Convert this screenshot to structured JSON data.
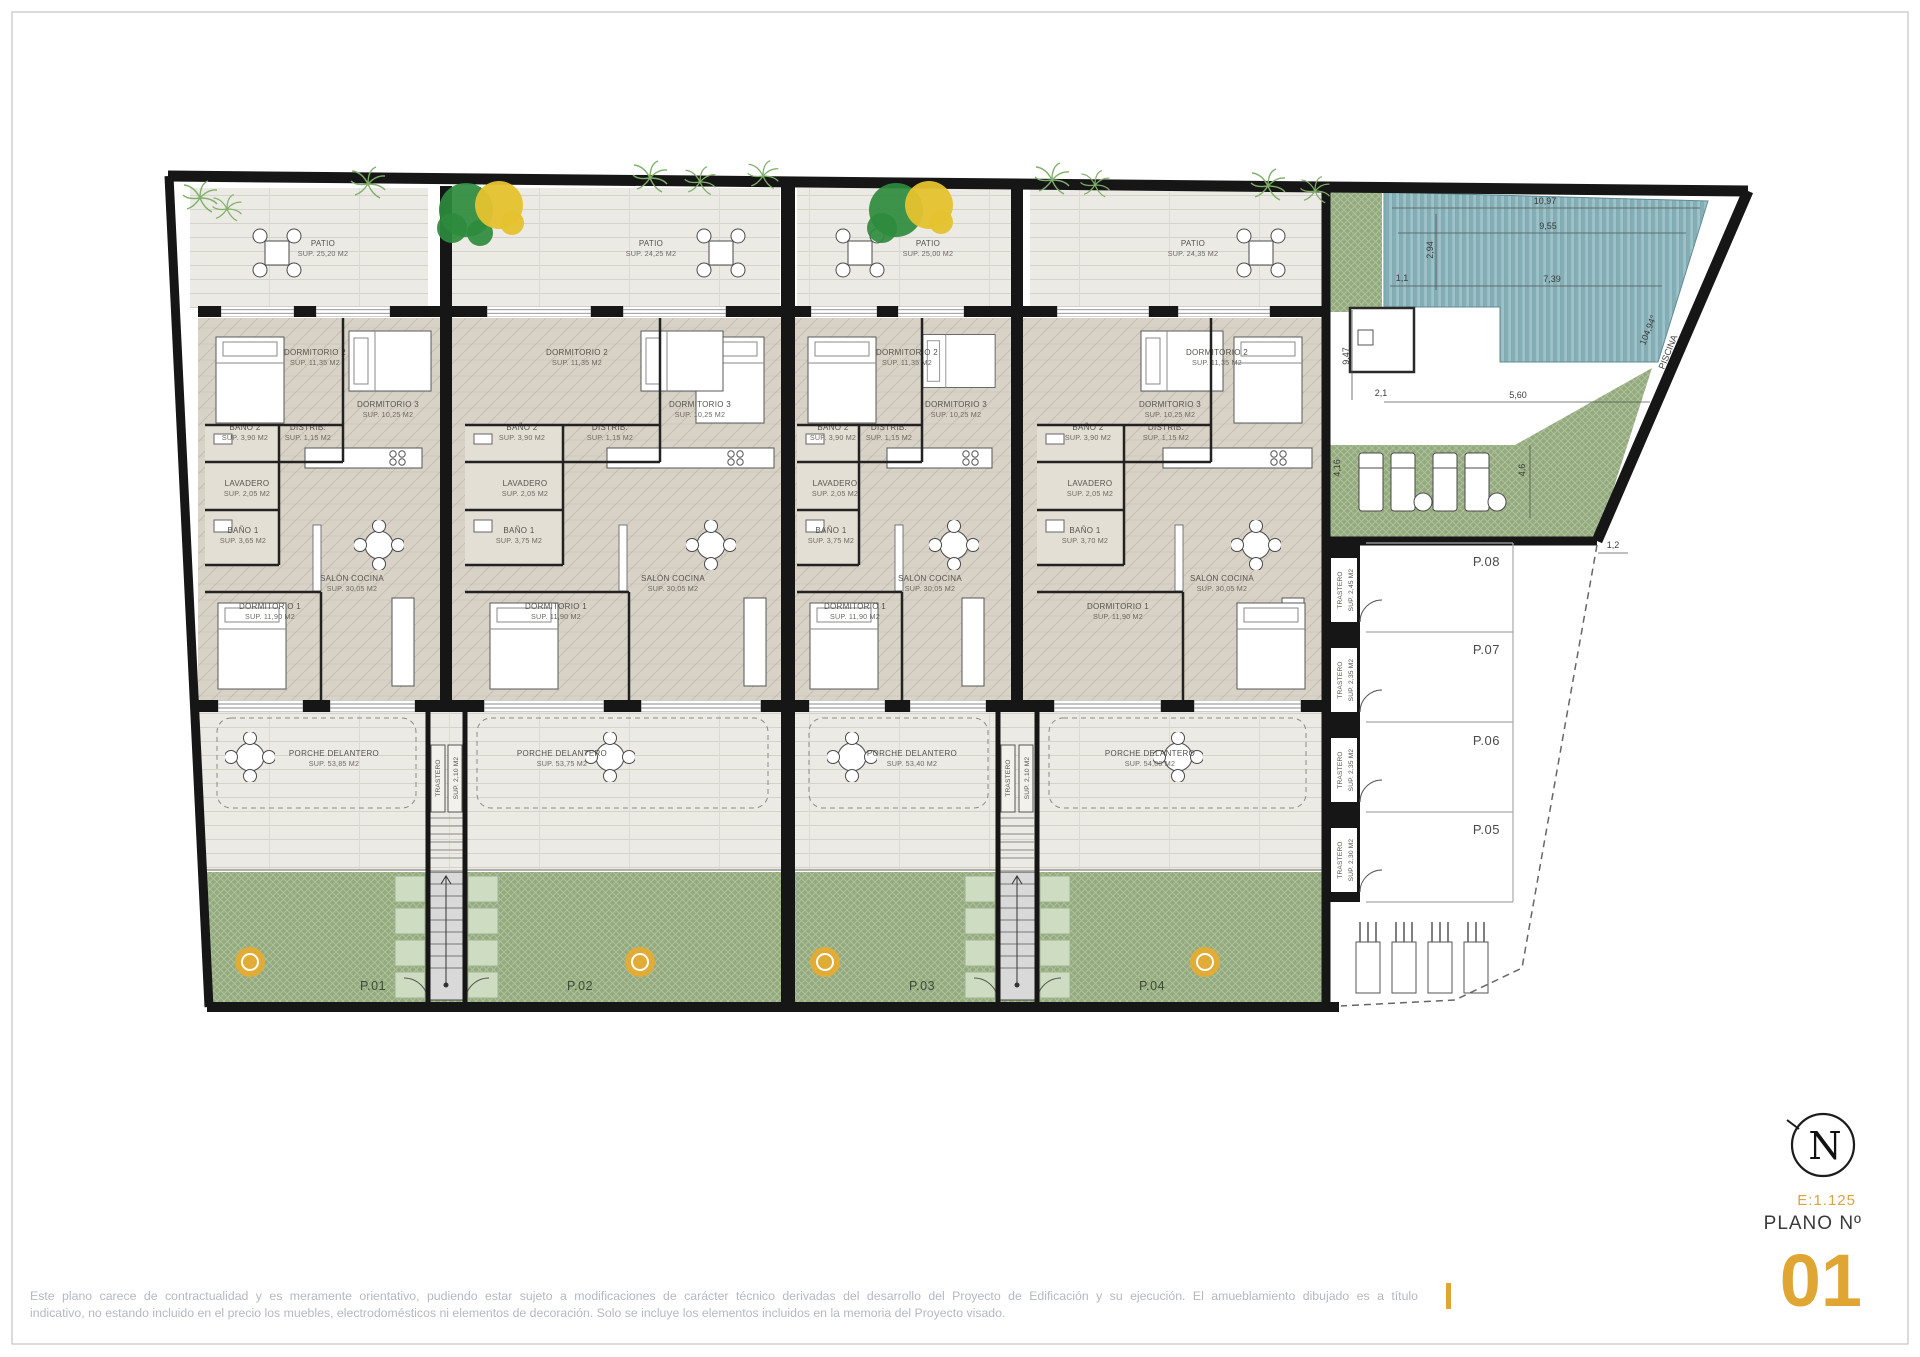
{
  "page": {
    "background": "#ffffff",
    "frame_color": "#cfcfcf"
  },
  "plan": {
    "units": [
      {
        "plot": "P.01",
        "patio": {
          "name": "PATIO",
          "area": "SUP. 25,20 M2"
        },
        "dormitorio2": {
          "name": "DORMITORIO 2",
          "area": "SUP. 11,35 M2"
        },
        "dormitorio3": {
          "name": "DORMITORIO 3",
          "area": "SUP. 10,25 M2"
        },
        "bano2": {
          "name": "BAÑO 2",
          "area": "SUP. 3,90 M2"
        },
        "distrib": {
          "name": "DISTRIB.",
          "area": "SUP. 1,15 M2"
        },
        "lavadero": {
          "name": "LAVADERO",
          "area": "SUP. 2,05 M2"
        },
        "bano1": {
          "name": "BAÑO 1",
          "area": "SUP. 3,65 M2"
        },
        "salon": {
          "name": "SALÓN COCINA",
          "area": "SUP. 30,05 M2"
        },
        "dormitorio1": {
          "name": "DORMITORIO 1",
          "area": "SUP. 11,90 M2"
        },
        "porche": {
          "name": "PORCHE DELANTERO",
          "area": "SUP. 53,85 M2"
        }
      },
      {
        "plot": "P.02",
        "patio": {
          "name": "PATIO",
          "area": "SUP. 24,25 M2"
        },
        "dormitorio2": {
          "name": "DORMITORIO 2",
          "area": "SUP. 11,35 M2"
        },
        "dormitorio3": {
          "name": "DORMITORIO 3",
          "area": "SUP. 10,25 M2"
        },
        "bano2": {
          "name": "BAÑO 2",
          "area": "SUP. 3,90 M2"
        },
        "distrib": {
          "name": "DISTRIB.",
          "area": "SUP. 1,15 M2"
        },
        "lavadero": {
          "name": "LAVADERO",
          "area": "SUP. 2,05 M2"
        },
        "bano1": {
          "name": "BAÑO 1",
          "area": "SUP. 3,75 M2"
        },
        "salon": {
          "name": "SALÓN COCINA",
          "area": "SUP. 30,05 M2"
        },
        "dormitorio1": {
          "name": "DORMITORIO 1",
          "area": "SUP. 11,90 M2"
        },
        "porche": {
          "name": "PORCHE DELANTERO",
          "area": "SUP. 53,75 M2"
        }
      },
      {
        "plot": "P.03",
        "patio": {
          "name": "PATIO",
          "area": "SUP. 25,00 M2"
        },
        "dormitorio2": {
          "name": "DORMITORIO 2",
          "area": "SUP. 11,35 M2"
        },
        "dormitorio3": {
          "name": "DORMITORIO 3",
          "area": "SUP. 10,25 M2"
        },
        "bano2": {
          "name": "BAÑO 2",
          "area": "SUP. 3,90 M2"
        },
        "distrib": {
          "name": "DISTRIB.",
          "area": "SUP. 1,15 M2"
        },
        "lavadero": {
          "name": "LAVADERO",
          "area": "SUP. 2,05 M2"
        },
        "bano1": {
          "name": "BAÑO 1",
          "area": "SUP. 3,75 M2"
        },
        "salon": {
          "name": "SALÓN COCINA",
          "area": "SUP. 30,05 M2"
        },
        "dormitorio1": {
          "name": "DORMITORIO 1",
          "area": "SUP. 11,90 M2"
        },
        "porche": {
          "name": "PORCHE DELANTERO",
          "area": "SUP. 53,40 M2"
        }
      },
      {
        "plot": "P.04",
        "patio": {
          "name": "PATIO",
          "area": "SUP. 24,35 M2"
        },
        "dormitorio2": {
          "name": "DORMITORIO 2",
          "area": "SUP. 11,35 M2"
        },
        "dormitorio3": {
          "name": "DORMITORIO 3",
          "area": "SUP. 10,25 M2"
        },
        "bano2": {
          "name": "BAÑO 2",
          "area": "SUP. 3,90 M2"
        },
        "distrib": {
          "name": "DISTRIB.",
          "area": "SUP. 1,15 M2"
        },
        "lavadero": {
          "name": "LAVADERO",
          "area": "SUP. 2,05 M2"
        },
        "bano1": {
          "name": "BAÑO 1",
          "area": "SUP. 3,70 M2"
        },
        "salon": {
          "name": "SALÓN COCINA",
          "area": "SUP. 30,05 M2"
        },
        "dormitorio1": {
          "name": "DORMITORIO 1",
          "area": "SUP. 11,90 M2"
        },
        "porche": {
          "name": "PORCHE DELANTERO",
          "area": "SUP. 54,00 M2"
        }
      }
    ],
    "stair_storage": {
      "name": "TRASTERO",
      "area": "SUP. 2,10 M2"
    },
    "storage_units": [
      {
        "name": "TRASTERO",
        "area": "SUP. 2,45 M2"
      },
      {
        "name": "TRASTERO",
        "area": "SUP. 2,35 M2"
      },
      {
        "name": "TRASTERO",
        "area": "SUP. 2,35 M2"
      },
      {
        "name": "TRASTERO",
        "area": "SUP. 2,30 M2"
      }
    ],
    "parking_spaces": [
      "P.08",
      "P.07",
      "P.06",
      "P.05"
    ],
    "pool": {
      "label": "PISCINA",
      "dims": {
        "top": "10,97",
        "mid": "9,55",
        "low": "7,39",
        "left": "2,94",
        "side": "9,47",
        "a": "2,1",
        "b": "1,1",
        "angle": "104,94°",
        "c": "5,60",
        "d": "4,6",
        "e": "1,2",
        "f": "4,16"
      }
    }
  },
  "title_block": {
    "scale": "E:1.125",
    "plan_label": "PLANO Nº",
    "plan_number": "01",
    "compass_letter": "N",
    "accent_color": "#e0a633"
  },
  "disclaimer": {
    "line1": "Este plano carece de contractualidad y es meramente orientativo, pudiendo estar sujeto a modificaciones de carácter técnico derivadas del desarrollo del Proyecto de Edificación y su ejecución. El amueblamiento dibujado es a título",
    "line2": "indicativo, no estando incluido en el precio los muebles, electrodomésticos ni elementos de decoración. Solo se incluye los elementos incluidos en la memoria del Proyecto visado."
  }
}
